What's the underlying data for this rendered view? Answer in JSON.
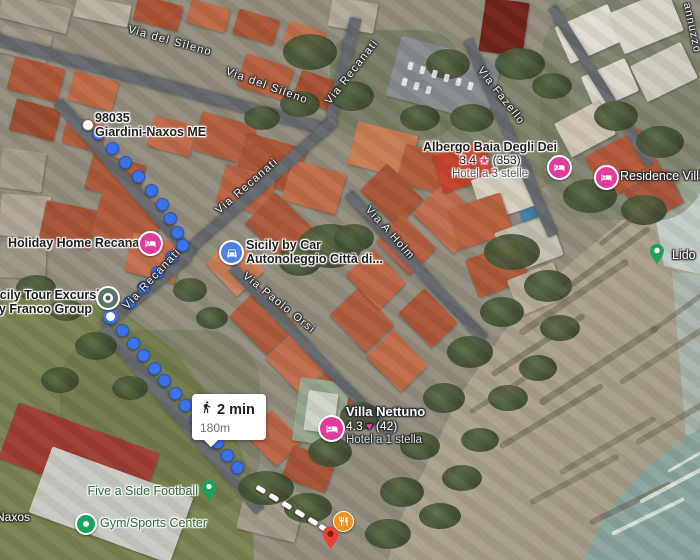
{
  "colors": {
    "route-blue": "#3b72e8",
    "pin-red": "#ea4335",
    "lodging-pink": "#e23d9c",
    "poi-green": "#1aa260",
    "car-blue": "#4d82e3",
    "restaurant-orange": "#ef9222"
  },
  "route": {
    "duration": "2 min",
    "distance": "180m"
  },
  "origin": {
    "postal_code": "98035",
    "city": "Giardini-Naxos ME"
  },
  "locality": "Naxos",
  "icons": {
    "star": "★",
    "heart": "♥"
  },
  "streets": {
    "sileno1": "Via del Sileno",
    "sileno2": "Via del Sileno",
    "recanati_top": "Via Recanati",
    "recanati_mid": "Via Recanati",
    "recanati_low": "Via Recanati",
    "fazello": "Via Fazello",
    "holm": "Via A Holm",
    "paolo_orsi": "Via Paolo Orsi",
    "jannuzzo": "annuzzo"
  },
  "pois": {
    "holiday_home": {
      "name": "Holiday Home Recanati"
    },
    "sicily_tour": {
      "line1": "Sicily Tour Excursion",
      "line2": "by Franco Group"
    },
    "sicily_by_car": {
      "line1": "Sicily by Car",
      "line2": "Autonoleggio Città di..."
    },
    "albergo": {
      "name": "Albergo Baia Degli Dei",
      "rating": "3.4",
      "reviews": "(353)",
      "subtitle": "Hotel a 3 stelle"
    },
    "residence": {
      "name": "Residence Villa"
    },
    "lido": {
      "name": "Lido"
    },
    "villa_nettuno": {
      "name": "Villa Nettuno",
      "rating": "4.3",
      "reviews": "(42)",
      "subtitle": "Hotel a 1 stella"
    },
    "five_a_side": {
      "name": "Five a Side Football"
    },
    "gym": {
      "name": "Gym/Sports Center"
    }
  }
}
